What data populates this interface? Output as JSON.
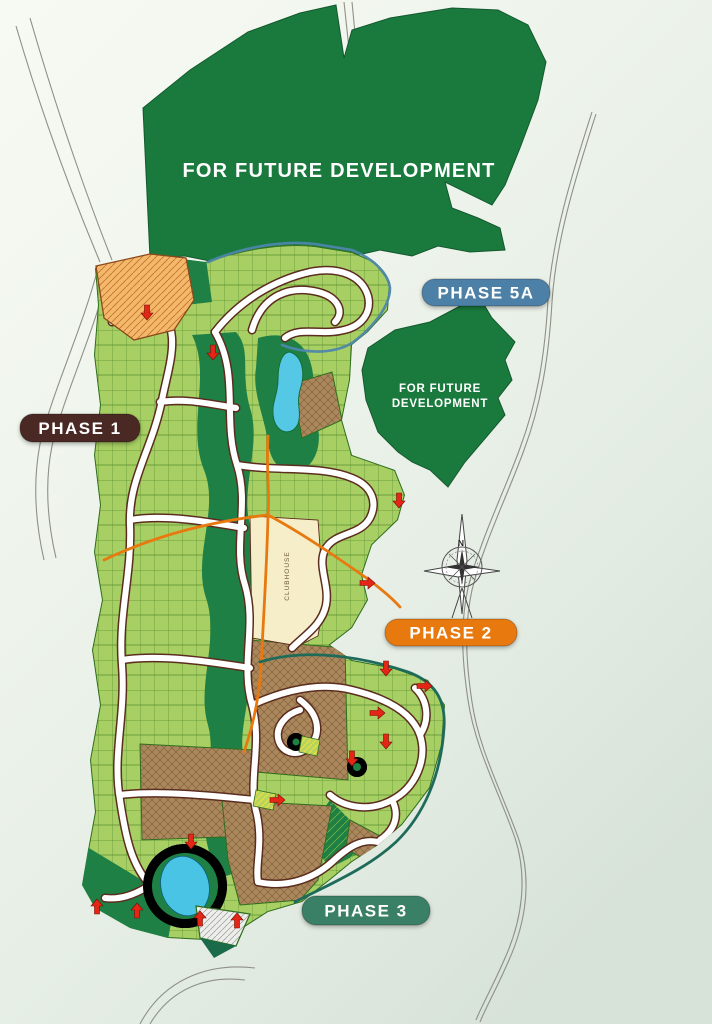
{
  "map": {
    "type": "subdivision-masterplan",
    "future_development": {
      "primary_label": "FOR FUTURE DEVELOPMENT",
      "secondary_label_line1": "FOR FUTURE",
      "secondary_label_line2": "DEVELOPMENT",
      "fill": "#1a7a3e",
      "text_color": "#ffffff"
    },
    "phase_labels": {
      "phase1": {
        "label": "PHASE 1",
        "fill": "#4a2823",
        "text_color": "#ffffff"
      },
      "phase2": {
        "label": "PHASE 2",
        "fill": "#e8790f",
        "text_color": "#ffffff"
      },
      "phase3": {
        "label": "PHASE 3",
        "fill": "#3a8066",
        "text_color": "#ffffff"
      },
      "phase5a": {
        "label": "PHASE 5A",
        "fill": "#4d80a6",
        "text_color": "#ffffff"
      }
    },
    "landmarks": {
      "clubhouse_label": "CLUBHOUSE",
      "compass_north_label": "N"
    },
    "palette": {
      "background_light": "#f7faf3",
      "background_dark": "#d7e2d8",
      "lot_fill": "#a8cf63",
      "lot_line": "#4b8228",
      "open_space": "#1f8045",
      "road_fill": "#ffffff",
      "road_casing": "#5b2d1f",
      "pond_blue": "#55c8e6",
      "clubhouse_fill": "#f6eec9",
      "reserved_lot_brown": "#ab875d",
      "commercial_hatch": "#f4b86c",
      "phase2_boundary": "#e8790f",
      "phase5a_boundary": "#4d86ab",
      "phase3_boundary": "#1f6b5a",
      "sold_marker_red": "#e42617",
      "outside_road_line": "#8f9086"
    }
  }
}
